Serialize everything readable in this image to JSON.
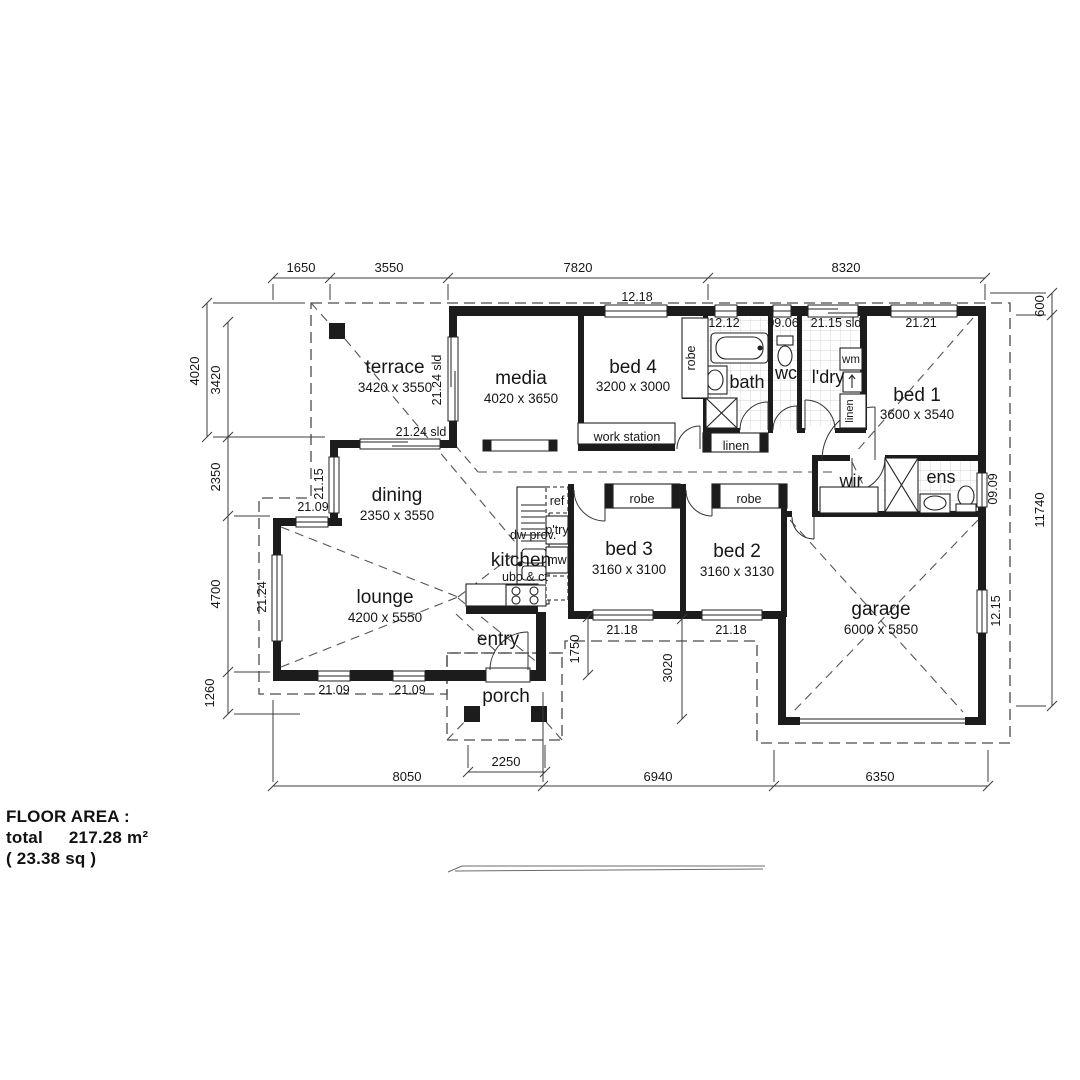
{
  "floor_area": {
    "heading": "FLOOR AREA :",
    "total_label": "total",
    "total_value": "217.28 m²",
    "alt_value": "( 23.38 sq )"
  },
  "rooms": {
    "terrace": {
      "name": "terrace",
      "dims": "3420 x 3550"
    },
    "media": {
      "name": "media",
      "dims": "4020 x 3650"
    },
    "bed4": {
      "name": "bed 4",
      "dims": "3200 x 3000"
    },
    "bed1": {
      "name": "bed 1",
      "dims": "3600 x 3540"
    },
    "bed3": {
      "name": "bed 3",
      "dims": "3160 x 3100"
    },
    "bed2": {
      "name": "bed 2",
      "dims": "3160 x 3130"
    },
    "dining": {
      "name": "dining",
      "dims": "2350 x 3550"
    },
    "lounge": {
      "name": "lounge",
      "dims": "4200 x 5550"
    },
    "garage": {
      "name": "garage",
      "dims": "6000 x 5850"
    },
    "kitchen": {
      "name": "kitchen"
    },
    "bath": {
      "name": "bath"
    },
    "wc": {
      "name": "wc"
    },
    "ldry": {
      "name": "l'dry"
    },
    "wir": {
      "name": "wir"
    },
    "ens": {
      "name": "ens"
    },
    "entry": {
      "name": "entry"
    },
    "porch": {
      "name": "porch"
    }
  },
  "fixtures": {
    "work_station": "work station",
    "robe": "robe",
    "linen": "linen",
    "wm": "wm",
    "ref": "ref",
    "pantry": "p'try",
    "mw": "mw",
    "dw_prov": "dw prov.",
    "ubo_ct": "ubo & ct"
  },
  "dims": {
    "top": [
      "1650",
      "3550",
      "7820",
      "8320"
    ],
    "bottom": [
      "8050",
      "2250",
      "6940",
      "6350"
    ],
    "left": [
      "4020",
      "3420",
      "2350",
      "4700",
      "1260"
    ],
    "right": [
      "600",
      "11740"
    ],
    "interior": [
      "1750",
      "3020"
    ]
  },
  "windows": {
    "n1218": "12.18",
    "n1212": "12.12",
    "n0906": "09.06",
    "sld2115": "21.15 sld",
    "n2121": "21.21",
    "e0909": "09.09",
    "e1215": "12.15",
    "sld2124": "21.24 sld",
    "w2115": "21.15",
    "w2109": "21.09",
    "w2124": "21.24",
    "s2118": "21.18"
  }
}
